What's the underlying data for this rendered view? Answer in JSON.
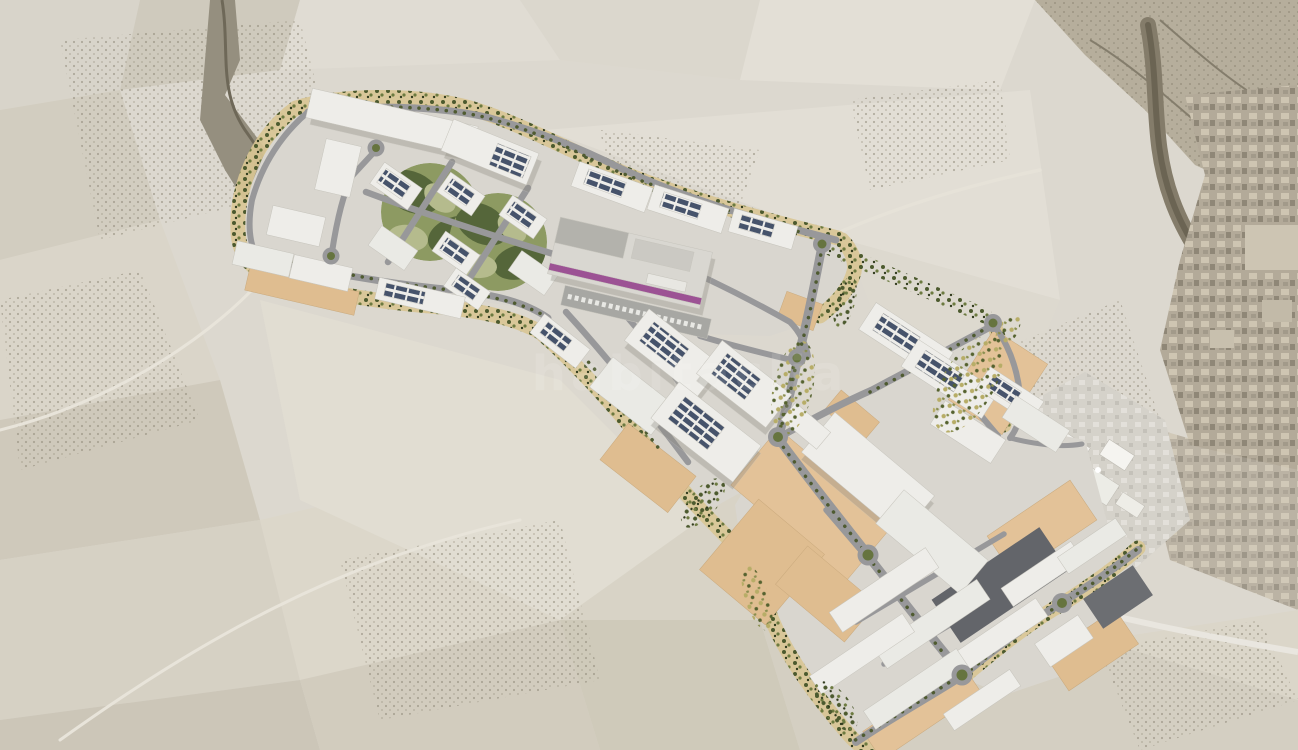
{
  "image": {
    "kind": "aerial-masterplan-render",
    "subject": "industrial-park-development-plan-over-aerial-photo"
  },
  "watermark": {
    "text": "habitaclia",
    "color": "#ffffff",
    "opacity": 0.32
  },
  "palette": {
    "terrain_light": "#e0dcd3",
    "terrain_mid": "#cfcabd",
    "terrain_dark": "#b6ae9c",
    "ravine": "#958f7f",
    "canyon": "#847c6a",
    "building_roof": "#eeede9",
    "building_complex_roof": "#d9d7d1",
    "solar_panel": "#46536b",
    "road": "#98989a",
    "roundabout_green": "#66743f",
    "greenbelt_tan": "#d9c694",
    "tree_dark": "#4c5a2e",
    "tree_olive": "#6c7a40",
    "tree_yellow": "#b7ad67",
    "park_green_base": "#8d9a62",
    "park_green_dark": "#55663a",
    "park_green_light": "#b5bb8d",
    "vacant_plot_tan": "#dfbd90",
    "paved_dark": "#63656a",
    "retail_stripe_purple": "#9c5294",
    "town_sepia": "#b3aa99",
    "highway_light": "#e9e6df"
  },
  "features": {
    "background": [
      "farm-field-patchwork",
      "olive-groves",
      "ravine",
      "hills",
      "canyon",
      "existing-town",
      "existing-industrial-area",
      "highway"
    ],
    "masterplan": [
      "greenbelt-boundary",
      "solar-roof-warehouses",
      "circular-green-parks",
      "central-retail-complex",
      "tree-lined-avenues",
      "roundabouts",
      "vacant-tan-plots",
      "dark-paved-lots",
      "parking-rows"
    ],
    "roundabout_count": 9,
    "green_park_count": 2
  }
}
